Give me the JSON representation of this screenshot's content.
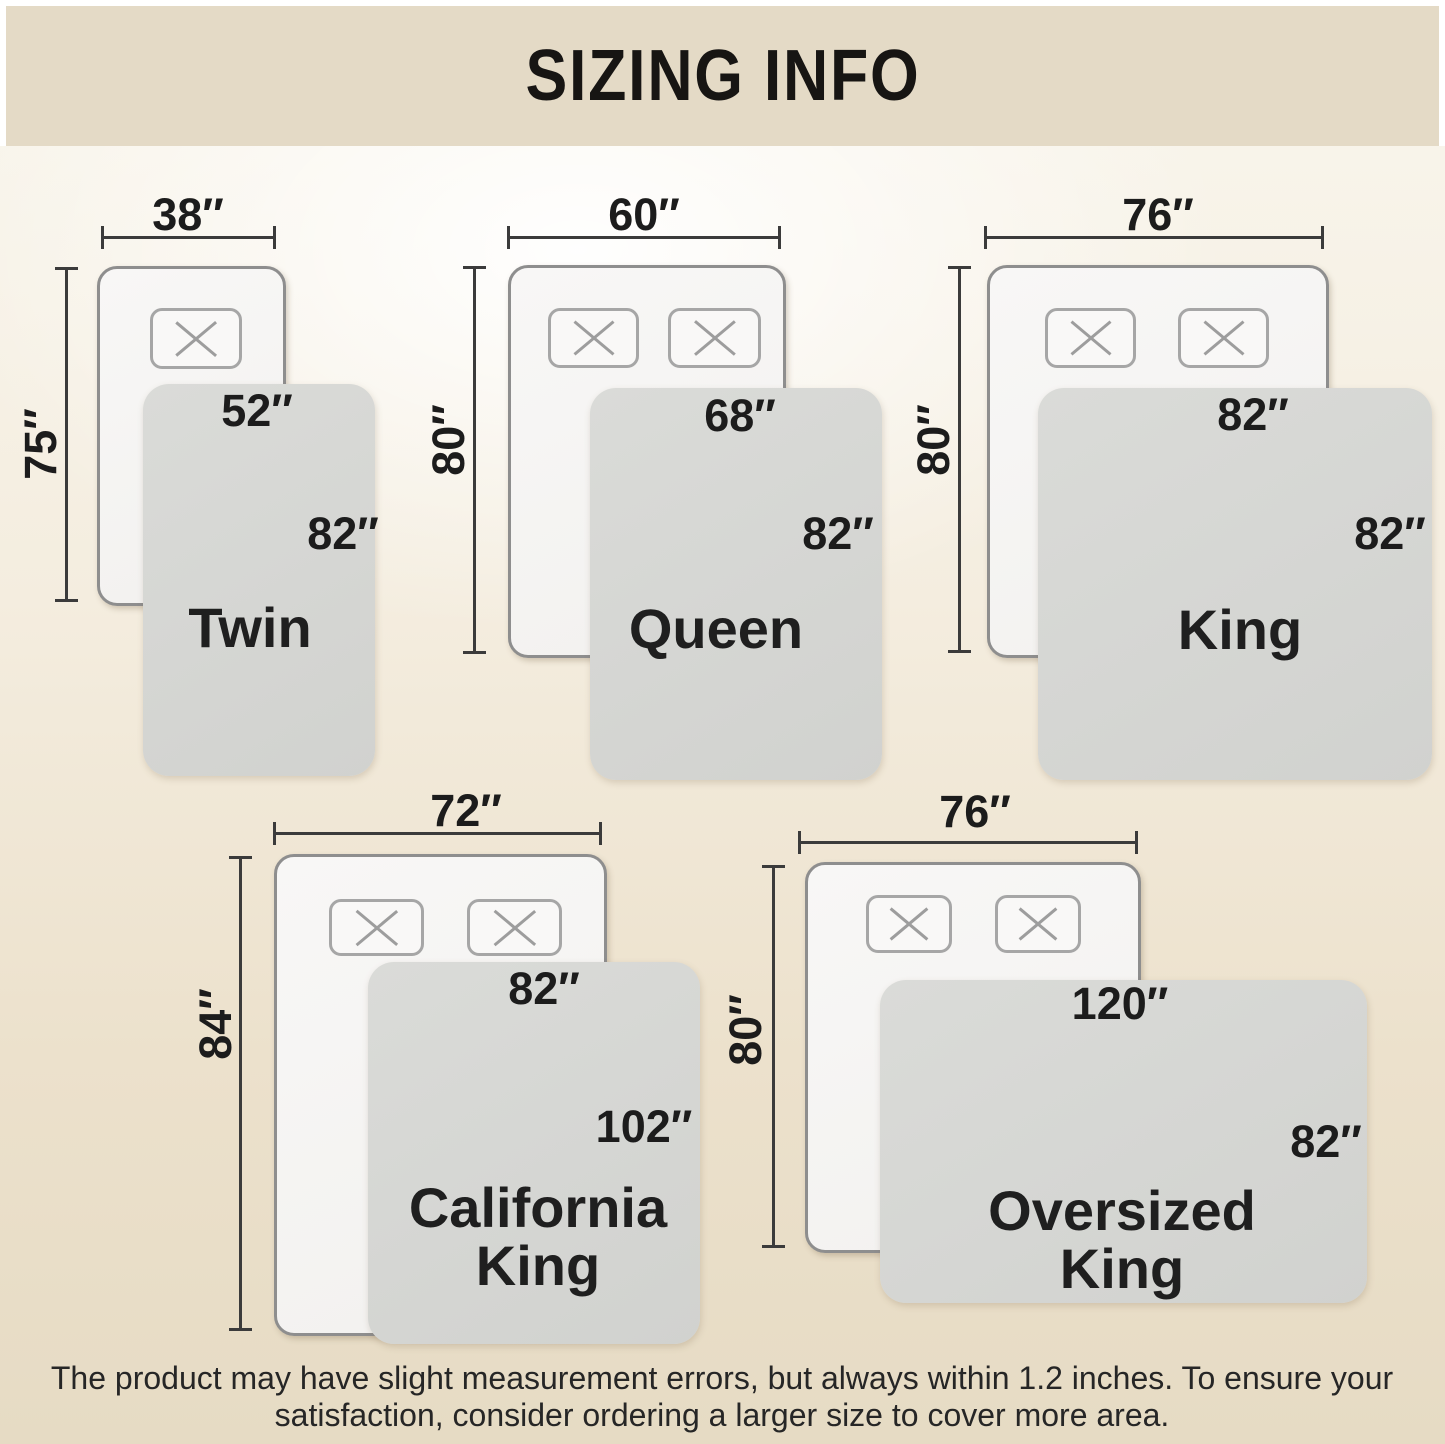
{
  "header": {
    "title": "SIZING INFO"
  },
  "sizes": [
    {
      "name": "Twin",
      "bed_width": "38″",
      "bed_length": "75″",
      "blanket_width": "52″",
      "blanket_length": "82″",
      "pillows": 1
    },
    {
      "name": "Queen",
      "bed_width": "60″",
      "bed_length": "80″",
      "blanket_width": "68″",
      "blanket_length": "82″",
      "pillows": 2
    },
    {
      "name": "King",
      "bed_width": "76″",
      "bed_length": "80″",
      "blanket_width": "82″",
      "blanket_length": "82″",
      "pillows": 2
    },
    {
      "name": "California\nKing",
      "bed_width": "72″",
      "bed_length": "84″",
      "blanket_width": "82″",
      "blanket_length": "102″",
      "pillows": 2
    },
    {
      "name": "Oversized\nKing",
      "bed_width": "76″",
      "bed_length": "80″",
      "blanket_width": "120″",
      "blanket_length": "82″",
      "pillows": 2
    }
  ],
  "footer": {
    "note": "The product may have slight measurement errors, but always within 1.2 inches. To ensure your\nsatisfaction, consider ordering a larger size to cover more area."
  },
  "colors": {
    "header_bg": "#e4dac6",
    "background_bottom": "#e6dbc4",
    "blanket": "#d5d6d3",
    "bed_border": "#8e8e8e",
    "dimension_line": "#3b3b3b",
    "text": "#1c1c1c"
  }
}
